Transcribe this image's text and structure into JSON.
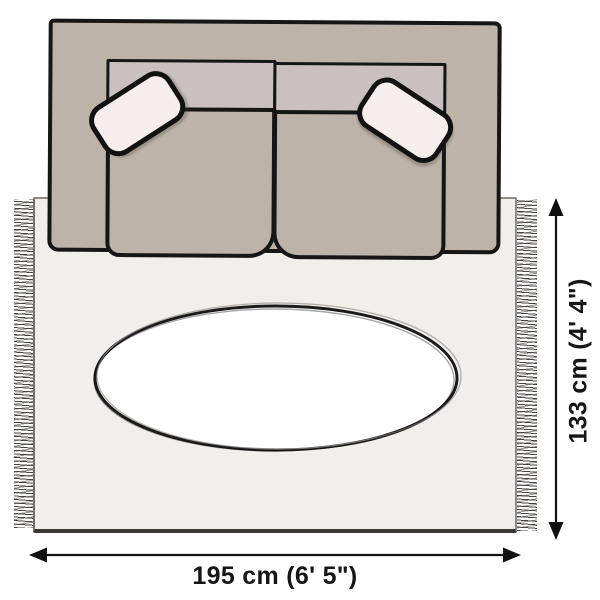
{
  "dimensions": {
    "width_label": "195 cm (6' 5\")",
    "height_label": "133 cm (4' 4\")"
  },
  "colors": {
    "background": "#ffffff",
    "sofa_body": "#bdb3a8",
    "sofa_backrest": "#cac0c1",
    "pillow": "#f6eded",
    "pillow_outline": "#121212",
    "outline": "#161616",
    "rug": "#f1efeb",
    "rug_edge": "#8f8b87",
    "rug_edge_bottom": "#3a3836",
    "fringe": "#46423d",
    "oval": "#ffffff",
    "arrow": "#111111"
  }
}
